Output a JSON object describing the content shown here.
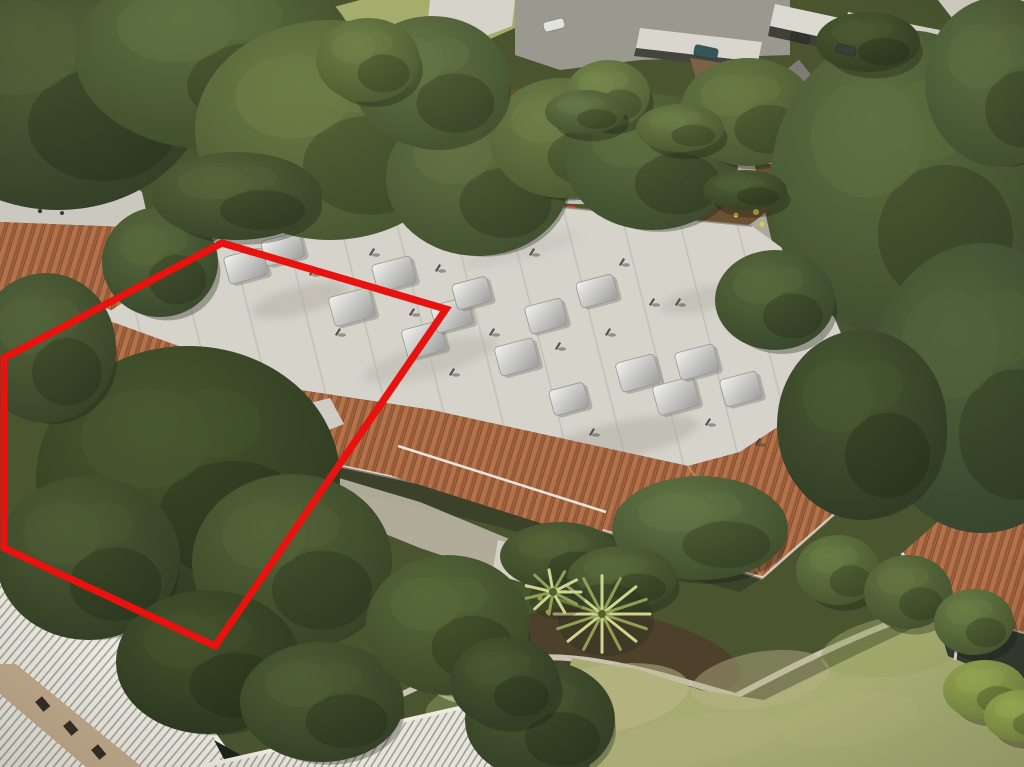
{
  "scene": {
    "kind": "aerial-drone-photo",
    "subject": "single-story condo building with red property boundary outline, trees, street and lawn"
  },
  "palette": {
    "red_outline": "#e8120e",
    "white_roof": "#d6d3cb",
    "tile_roof": "#b4724a",
    "tile_dark_row": "#935839",
    "asphalt_street": "#7d7b73",
    "asphalt_parking": "#9b9890",
    "concrete": "#c9c4b6",
    "corrugated_roof": "#eceae1",
    "lawn": "#a6ab72",
    "grass_hill": "#a5ad6c",
    "tree_dark": "#2b361f",
    "beige_wall": "#c9b795",
    "red_curb": "#b5453a",
    "mulch": "#6a5339"
  },
  "property_outline": {
    "points": "222,243 446,309 215,646 4,548 4,358",
    "stroke_width": 7.2
  },
  "building": {
    "skylights": [
      [
        246,
        266,
        40,
        28
      ],
      [
        283,
        249,
        40,
        26
      ],
      [
        352,
        307,
        42,
        30
      ],
      [
        394,
        274,
        40,
        28
      ],
      [
        424,
        340,
        40,
        30
      ],
      [
        452,
        315,
        38,
        28
      ],
      [
        472,
        293,
        36,
        26
      ],
      [
        517,
        357,
        40,
        30
      ],
      [
        546,
        316,
        38,
        28
      ],
      [
        597,
        291,
        38,
        26
      ],
      [
        638,
        373,
        40,
        30
      ],
      [
        676,
        396,
        42,
        30
      ],
      [
        697,
        362,
        40,
        28
      ],
      [
        569,
        399,
        36,
        26
      ],
      [
        741,
        389,
        38,
        28
      ]
    ],
    "vents": [
      [
        312,
        272
      ],
      [
        338,
        332
      ],
      [
        372,
        252
      ],
      [
        438,
        268
      ],
      [
        492,
        332
      ],
      [
        558,
        346
      ],
      [
        608,
        332
      ],
      [
        652,
        302
      ],
      [
        708,
        422
      ],
      [
        758,
        442
      ],
      [
        532,
        252
      ],
      [
        452,
        372
      ],
      [
        592,
        432
      ],
      [
        678,
        302
      ],
      [
        412,
        312
      ],
      [
        622,
        262
      ]
    ]
  },
  "vegetation": {
    "clusters": [
      {
        "name": "canopy-topleft-a",
        "x": 58,
        "y": 85,
        "rx": 150,
        "ry": 125,
        "base": "#2f3a24",
        "hi": "#53643a"
      },
      {
        "name": "canopy-topleft-b",
        "x": 215,
        "y": 55,
        "rx": 140,
        "ry": 95,
        "base": "#3a4829",
        "hi": "#5f7141"
      },
      {
        "name": "canopy-center-left",
        "x": 330,
        "y": 130,
        "rx": 135,
        "ry": 110,
        "base": "#42512e",
        "hi": "#6b7d46"
      },
      {
        "name": "tree-over-street-left",
        "x": 160,
        "y": 262,
        "rx": 58,
        "ry": 55,
        "base": "#36432a",
        "hi": "#586a3c"
      },
      {
        "name": "branch-over-roof-corner",
        "x": 237,
        "y": 196,
        "rx": 85,
        "ry": 44,
        "base": "#333f27",
        "hi": "#556539"
      },
      {
        "name": "tree-center",
        "x": 478,
        "y": 178,
        "rx": 92,
        "ry": 78,
        "base": "#3d4b2c",
        "hi": "#617243"
      },
      {
        "name": "tree-top-center",
        "x": 562,
        "y": 138,
        "rx": 72,
        "ry": 60,
        "base": "#46552f",
        "hi": "#6d7f48"
      },
      {
        "name": "tree-over-street-mid",
        "x": 652,
        "y": 162,
        "rx": 86,
        "ry": 68,
        "base": "#39472b",
        "hi": "#5c6e3f"
      },
      {
        "name": "tree-top-right-mid",
        "x": 748,
        "y": 112,
        "rx": 68,
        "ry": 54,
        "base": "#42512e",
        "hi": "#687a44"
      },
      {
        "name": "tree-mass-right-upper",
        "x": 905,
        "y": 185,
        "rx": 135,
        "ry": 155,
        "base": "#3a482b",
        "hi": "#5d6f40"
      },
      {
        "name": "tree-mass-right-lower",
        "x": 982,
        "y": 388,
        "rx": 115,
        "ry": 145,
        "base": "#32402a",
        "hi": "#52643c"
      },
      {
        "name": "tree-right-of-building",
        "x": 862,
        "y": 425,
        "rx": 85,
        "ry": 95,
        "base": "#2c3722",
        "hi": "#485932"
      },
      {
        "name": "yard-tree-large",
        "x": 188,
        "y": 478,
        "rx": 152,
        "ry": 132,
        "base": "#2b361f",
        "hi": "#47572f"
      },
      {
        "name": "yard-tree-right",
        "x": 292,
        "y": 562,
        "rx": 100,
        "ry": 88,
        "base": "#334026",
        "hi": "#536337"
      },
      {
        "name": "yard-tree-left",
        "x": 88,
        "y": 558,
        "rx": 92,
        "ry": 82,
        "base": "#2f3b24",
        "hi": "#4c5c33"
      },
      {
        "name": "tree-below-yard",
        "x": 208,
        "y": 662,
        "rx": 92,
        "ry": 72,
        "base": "#29341e",
        "hi": "#44522c"
      },
      {
        "name": "tree-bottom-left",
        "x": 322,
        "y": 702,
        "rx": 82,
        "ry": 60,
        "base": "#303c24",
        "hi": "#4d5d34"
      },
      {
        "name": "bush-left-of-lawn",
        "x": 448,
        "y": 625,
        "rx": 82,
        "ry": 70,
        "base": "#364326",
        "hi": "#576939"
      },
      {
        "name": "bush-bottom-center",
        "x": 540,
        "y": 720,
        "rx": 75,
        "ry": 60,
        "base": "#2e3a23",
        "hi": "#4a5a32"
      },
      {
        "name": "bush-bottom-center-b",
        "x": 505,
        "y": 682,
        "rx": 55,
        "ry": 45,
        "base": "#2d3822",
        "hi": "#485831"
      },
      {
        "name": "magnolia-front",
        "x": 700,
        "y": 528,
        "rx": 88,
        "ry": 52,
        "base": "#3a482a",
        "hi": "#627645"
      },
      {
        "name": "tree-left-edge",
        "x": 46,
        "y": 348,
        "rx": 70,
        "ry": 75,
        "base": "#343f26",
        "hi": "#53643a"
      },
      {
        "name": "tree-top-center-b",
        "x": 432,
        "y": 82,
        "rx": 78,
        "ry": 66,
        "base": "#3f4e2d",
        "hi": "#647646"
      },
      {
        "name": "tree-top-right-corner",
        "x": 1000,
        "y": 82,
        "rx": 75,
        "ry": 85,
        "base": "#3b492c",
        "hi": "#5e7041"
      },
      {
        "name": "tree-right-driveway",
        "x": 775,
        "y": 300,
        "rx": 60,
        "ry": 50,
        "base": "#35422a",
        "hi": "#576a3c"
      },
      {
        "name": "hedge-ball-a",
        "x": 838,
        "y": 570,
        "rx": 42,
        "ry": 35,
        "base": "#42502c",
        "hi": "#687c44"
      },
      {
        "name": "hedge-ball-b",
        "x": 908,
        "y": 592,
        "rx": 44,
        "ry": 37,
        "base": "#3e4c2a",
        "hi": "#637542"
      },
      {
        "name": "hedge-ball-c",
        "x": 974,
        "y": 622,
        "rx": 40,
        "ry": 33,
        "base": "#44532e",
        "hi": "#6a7e46"
      },
      {
        "name": "shrub-yellow-a",
        "x": 985,
        "y": 690,
        "rx": 42,
        "ry": 30,
        "base": "#71803e",
        "hi": "#9aab55"
      },
      {
        "name": "shrub-yellow-b",
        "x": 1020,
        "y": 716,
        "rx": 36,
        "ry": 26,
        "base": "#75843f",
        "hi": "#a0b158"
      },
      {
        "name": "tree-small-top",
        "x": 368,
        "y": 60,
        "rx": 52,
        "ry": 42,
        "base": "#47562f",
        "hi": "#6f8147"
      },
      {
        "name": "tree-parking-edge",
        "x": 608,
        "y": 94,
        "rx": 42,
        "ry": 34,
        "base": "#4c5a33",
        "hi": "#75874c"
      },
      {
        "name": "shrub-street-a",
        "x": 585,
        "y": 112,
        "rx": 40,
        "ry": 22,
        "base": "#3f4d2c",
        "hi": "#657747"
      },
      {
        "name": "shrub-street-b",
        "x": 680,
        "y": 128,
        "rx": 44,
        "ry": 24,
        "base": "#44532d",
        "hi": "#6b7e46"
      },
      {
        "name": "cypress-row",
        "x": 868,
        "y": 42,
        "rx": 52,
        "ry": 30,
        "base": "#2e3a22",
        "hi": "#4a5a31"
      },
      {
        "name": "hedge-front-a",
        "x": 560,
        "y": 556,
        "rx": 60,
        "ry": 34,
        "base": "#333f25",
        "hi": "#536437"
      },
      {
        "name": "hedge-front-b",
        "x": 622,
        "y": 578,
        "rx": 55,
        "ry": 32,
        "base": "#364326",
        "hi": "#586a3a"
      },
      {
        "name": "hedge-below-white-roof",
        "x": 745,
        "y": 190,
        "rx": 42,
        "ry": 20,
        "base": "#313d24",
        "hi": "#4f6035"
      }
    ],
    "palms": [
      {
        "x": 602,
        "y": 614,
        "r": 48,
        "n": 16
      },
      {
        "x": 553,
        "y": 592,
        "r": 28,
        "n": 11
      }
    ]
  },
  "vehicles": [
    {
      "name": "teal-car-street",
      "x": 706,
      "y": 52,
      "w": 24,
      "h": 11,
      "rot": 12,
      "color": "#33565a"
    },
    {
      "name": "white-car-parking",
      "x": 554,
      "y": 25,
      "w": 21,
      "h": 10,
      "rot": -14,
      "color": "#e2e3de"
    },
    {
      "name": "carport-car-a",
      "x": 800,
      "y": 38,
      "w": 20,
      "h": 9,
      "rot": 14,
      "color": "#30332e"
    },
    {
      "name": "carport-car-b",
      "x": 846,
      "y": 50,
      "w": 20,
      "h": 9,
      "rot": 14,
      "color": "#3a3d36"
    }
  ],
  "lawn": {
    "patches": [
      {
        "x": 600,
        "y": 700,
        "rx": 90,
        "ry": 34,
        "fill": "#c0ba8a",
        "op": 0.5
      },
      {
        "x": 760,
        "y": 680,
        "rx": 70,
        "ry": 28,
        "fill": "#b7b184",
        "op": 0.45
      },
      {
        "x": 480,
        "y": 705,
        "rx": 55,
        "ry": 24,
        "fill": "#8e9a5c",
        "op": 0.5
      },
      {
        "x": 900,
        "y": 645,
        "rx": 80,
        "ry": 30,
        "fill": "#9aa464",
        "op": 0.5
      },
      {
        "x": 690,
        "y": 742,
        "rx": 95,
        "ry": 26,
        "fill": "#b3ac7e",
        "op": 0.4
      },
      {
        "x": 850,
        "y": 720,
        "rx": 70,
        "ry": 26,
        "fill": "#aeb279",
        "op": 0.4
      }
    ]
  }
}
